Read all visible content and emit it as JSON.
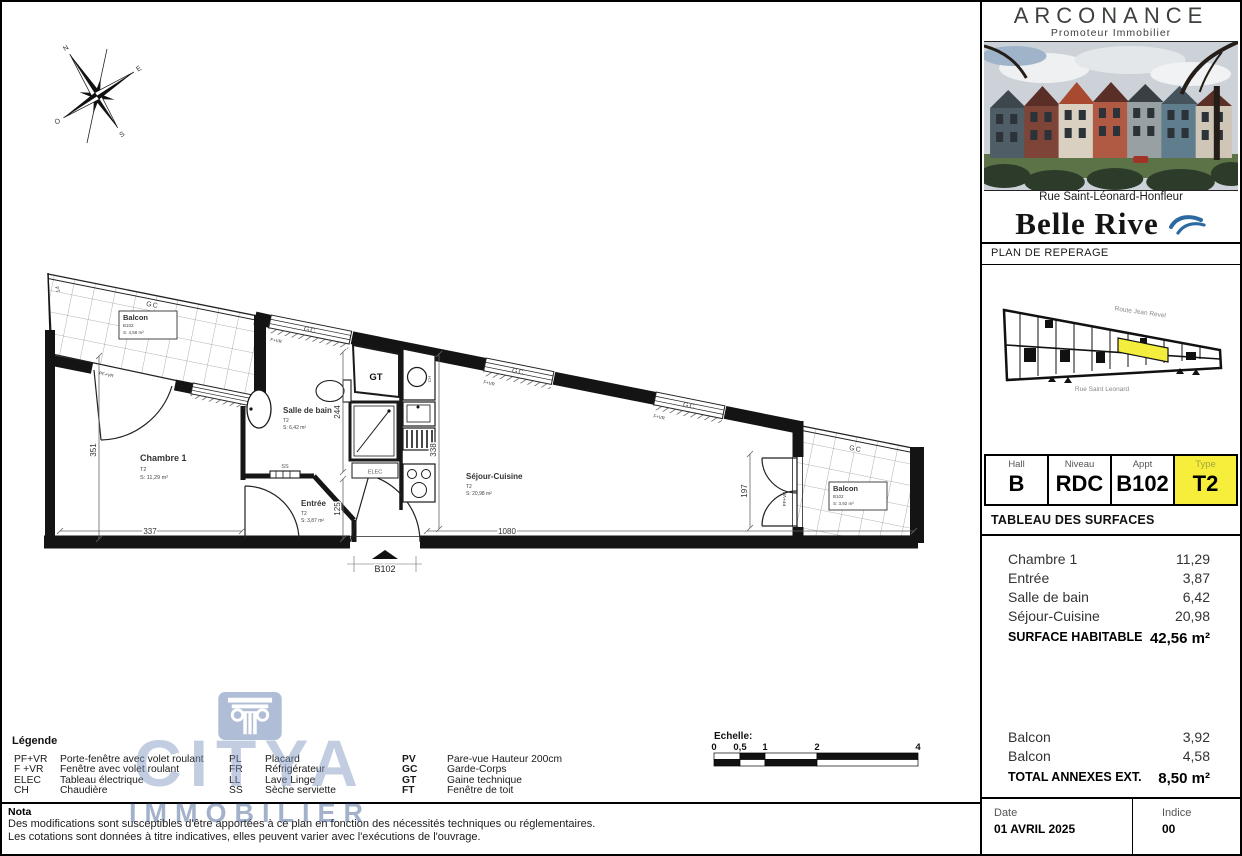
{
  "colors": {
    "accent_yellow": "#f6ee3a",
    "wave_blue": "#2b6aa0",
    "watermark_blue": "#7b92bd"
  },
  "header": {
    "developer_name": "ARCONANCE",
    "developer_tagline": "Promoteur Immobilier",
    "photo_caption": "Rue Saint-Léonard-Honfleur",
    "residence_name": "Belle Rive",
    "plan_label": "PLAN DE REPERAGE"
  },
  "mini_map": {
    "street_top": "Route Jean Revel",
    "street_bottom": "Rue Saint Leonard"
  },
  "unit_table": {
    "cells": [
      {
        "label": "Hall",
        "value": "B"
      },
      {
        "label": "Niveau",
        "value": "RDC"
      },
      {
        "label": "Appt",
        "value": "B102"
      },
      {
        "label": "Type",
        "value": "T2"
      }
    ]
  },
  "surfaces": {
    "title": "TABLEAU DES SURFACES",
    "rows": [
      {
        "label": "Chambre 1",
        "value": "11,29"
      },
      {
        "label": "Entrée",
        "value": "3,87"
      },
      {
        "label": "Salle de bain",
        "value": "6,42"
      },
      {
        "label": "Séjour-Cuisine",
        "value": "20,98"
      }
    ],
    "total_label": "SURFACE HABITABLE",
    "total_value": "42,56 m²",
    "annex_rows": [
      {
        "label": "Balcon",
        "value": "3,92"
      },
      {
        "label": "Balcon",
        "value": "4,58"
      }
    ],
    "annex_total_label": "TOTAL ANNEXES EXT.",
    "annex_total_value": "8,50 m²"
  },
  "footer": {
    "date_label": "Date",
    "date_value": "01 AVRIL 2025",
    "indice_label": "Indice",
    "indice_value": "00"
  },
  "plan": {
    "compass": {
      "n": "N",
      "e": "E",
      "s": "S",
      "w": "O"
    },
    "rooms": {
      "balcon_left": {
        "name": "Balcon",
        "code": "B102",
        "surface": "S: 4,58 m²"
      },
      "chambre": {
        "name": "Chambre 1",
        "type": "T2",
        "surface": "S: 11,29 m²"
      },
      "salle_de_bain": {
        "name": "Salle de bain",
        "type": "T2",
        "surface": "S: 6,42 m²"
      },
      "entree": {
        "name": "Entrée",
        "type": "T2",
        "surface": "S: 3,87 m²"
      },
      "sejour": {
        "name": "Séjour-Cuisine",
        "type": "T2",
        "surface": "S: 20,98 m²"
      },
      "balcon_right": {
        "name": "Balcon",
        "code": "B102",
        "surface": "S: 3,92 m²"
      }
    },
    "labels": {
      "gc": "GC",
      "fvr": "F+VR",
      "pfvr": "PF+VR",
      "gt": "GT",
      "elec": "ELEC",
      "ss": "SS",
      "ch": "CH",
      "ft": "FT",
      "entry": "B102"
    },
    "dims": {
      "d351": "351",
      "d337": "337",
      "d244": "244",
      "d125": "125",
      "d338": "338",
      "d1080": "1080",
      "d197": "197"
    }
  },
  "legend": {
    "title": "Légende",
    "col1": [
      {
        "abbr": "PF+VR",
        "desc": "Porte-fenêtre avec volet roulant"
      },
      {
        "abbr": "F +VR",
        "desc": "Fenêtre avec volet roulant"
      },
      {
        "abbr": "ELEC",
        "desc": "Tableau électrique"
      },
      {
        "abbr": "CH",
        "desc": "Chaudière"
      }
    ],
    "col2": [
      {
        "abbr": "PL",
        "desc": "Placard"
      },
      {
        "abbr": "FR",
        "desc": "Réfrigérateur"
      },
      {
        "abbr": "LL",
        "desc": "Lave Linge"
      },
      {
        "abbr": "SS",
        "desc": "Sèche serviette"
      }
    ],
    "col3": [
      {
        "abbr": "PV",
        "desc": "Pare-vue Hauteur 200cm"
      },
      {
        "abbr": "GC",
        "desc": "Garde-Corps"
      },
      {
        "abbr": "GT",
        "desc": "Gaine technique"
      },
      {
        "abbr": "FT",
        "desc": "Fenêtre de toit"
      }
    ]
  },
  "nota": {
    "title": "Nota",
    "line1": "Des modifications sont susceptibles d'être apportées à ce plan en fonction des nécessités techniques ou réglementaires.",
    "line2": "Les cotations sont données à titre indicatives, elles peuvent varier avec l'exécutions de l'ouvrage."
  },
  "scalebar": {
    "title": "Echelle:",
    "ticks": [
      "0",
      "0,5",
      "1",
      "2",
      "4"
    ]
  },
  "watermark": {
    "brand": "CITYA",
    "sub": "IMMOBILIER"
  }
}
